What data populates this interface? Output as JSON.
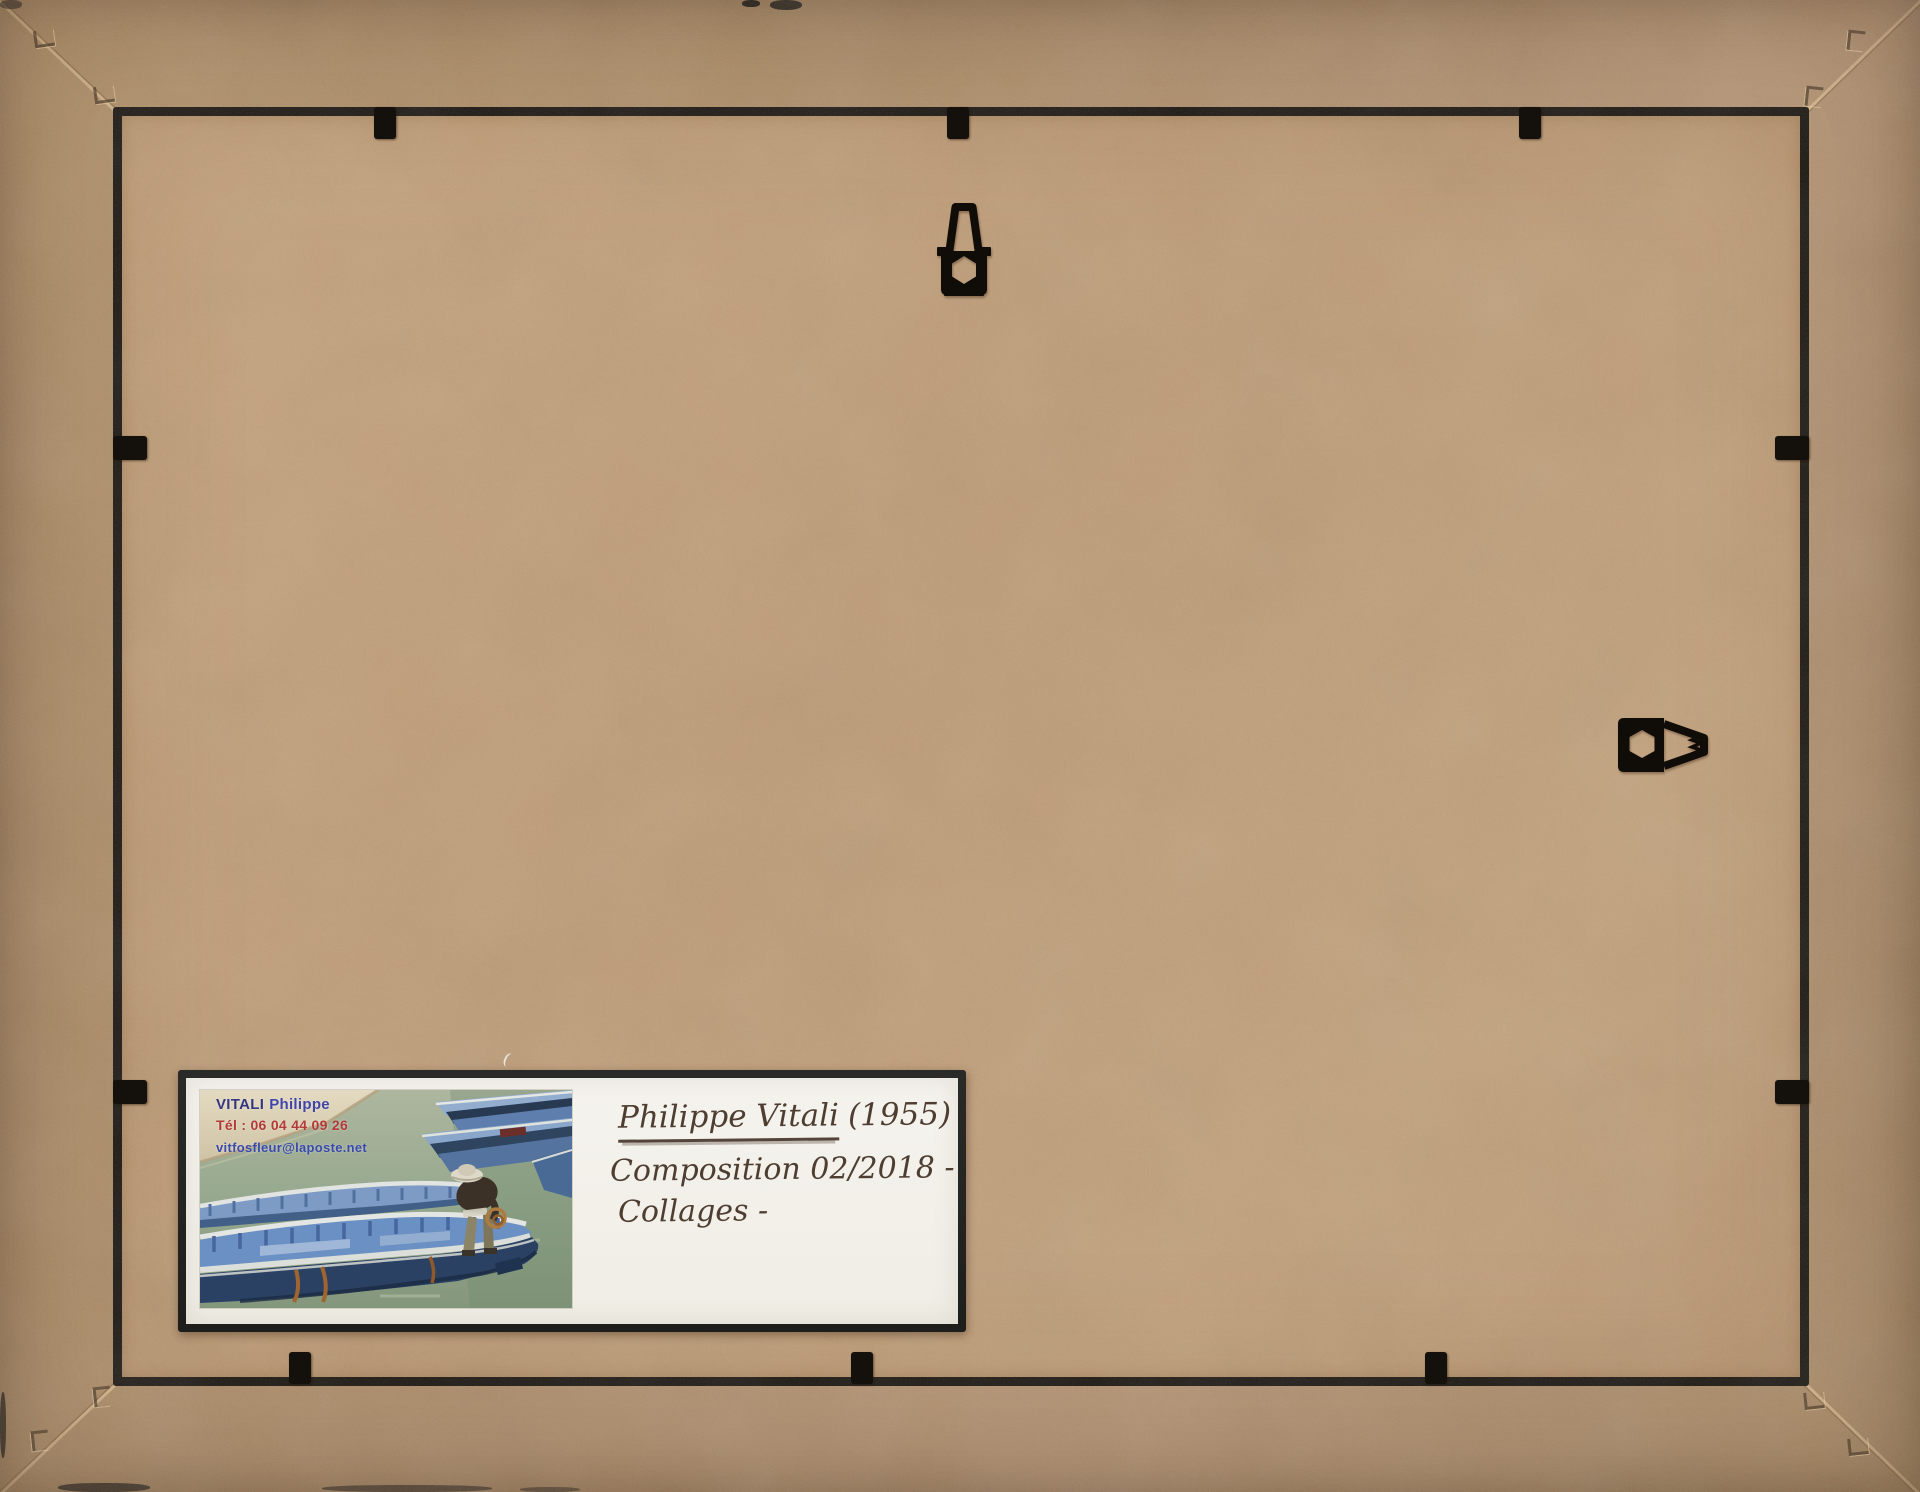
{
  "label": {
    "card": {
      "name_bold": "VITALI",
      "name_rest": "Philippe",
      "phone": "Tél : 06 04 44 09 26",
      "email": "vitfosfleur@laposte.net"
    },
    "handwriting": {
      "artist": "Philippe Vitali",
      "year": "(1955)",
      "line2": "Composition 02/2018 -",
      "line3": "Collages -"
    }
  },
  "hardware": {
    "top_hanger": "stamped-metal-hanging-bracket",
    "right_hanger": "stamped-metal-hanging-bracket",
    "clips": "black-retaining-clip"
  },
  "colors": {
    "frame_border": "#b09068",
    "backing_board": "#bd9b76",
    "gap_shadow": "#17120c",
    "hardware_black": "#14100c",
    "label_frame": "#242422",
    "label_paper": "#f3f1ea",
    "handwriting_ink": "#4e3d31",
    "card_blue_dark": "#33357f",
    "card_blue": "#3f46a8",
    "card_red": "#b23b38",
    "water_green": "#93a68e",
    "quay_beige": "#d8cdb2",
    "boat_light_blue": "#7e9bc6",
    "boat_rib_blue": "#4a6fae",
    "hull_navy": "#2b4163",
    "rope_rust": "#a0652f"
  }
}
